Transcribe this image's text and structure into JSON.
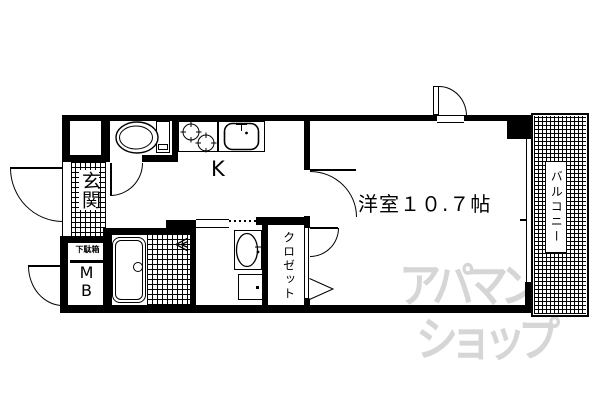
{
  "plan": {
    "labels": {
      "genkan": "玄関",
      "kitchen": "K",
      "main_room": "洋室１０.７帖",
      "balcony": "バルコニー",
      "closet": "クロゼット",
      "shoe_box": "下駄箱",
      "meter_box": "MB"
    },
    "watermark": {
      "line1": "アパマン",
      "line2": "ショップ",
      "color": "#d6d6d6"
    },
    "colors": {
      "wall": "#000000",
      "background": "#ffffff"
    }
  }
}
